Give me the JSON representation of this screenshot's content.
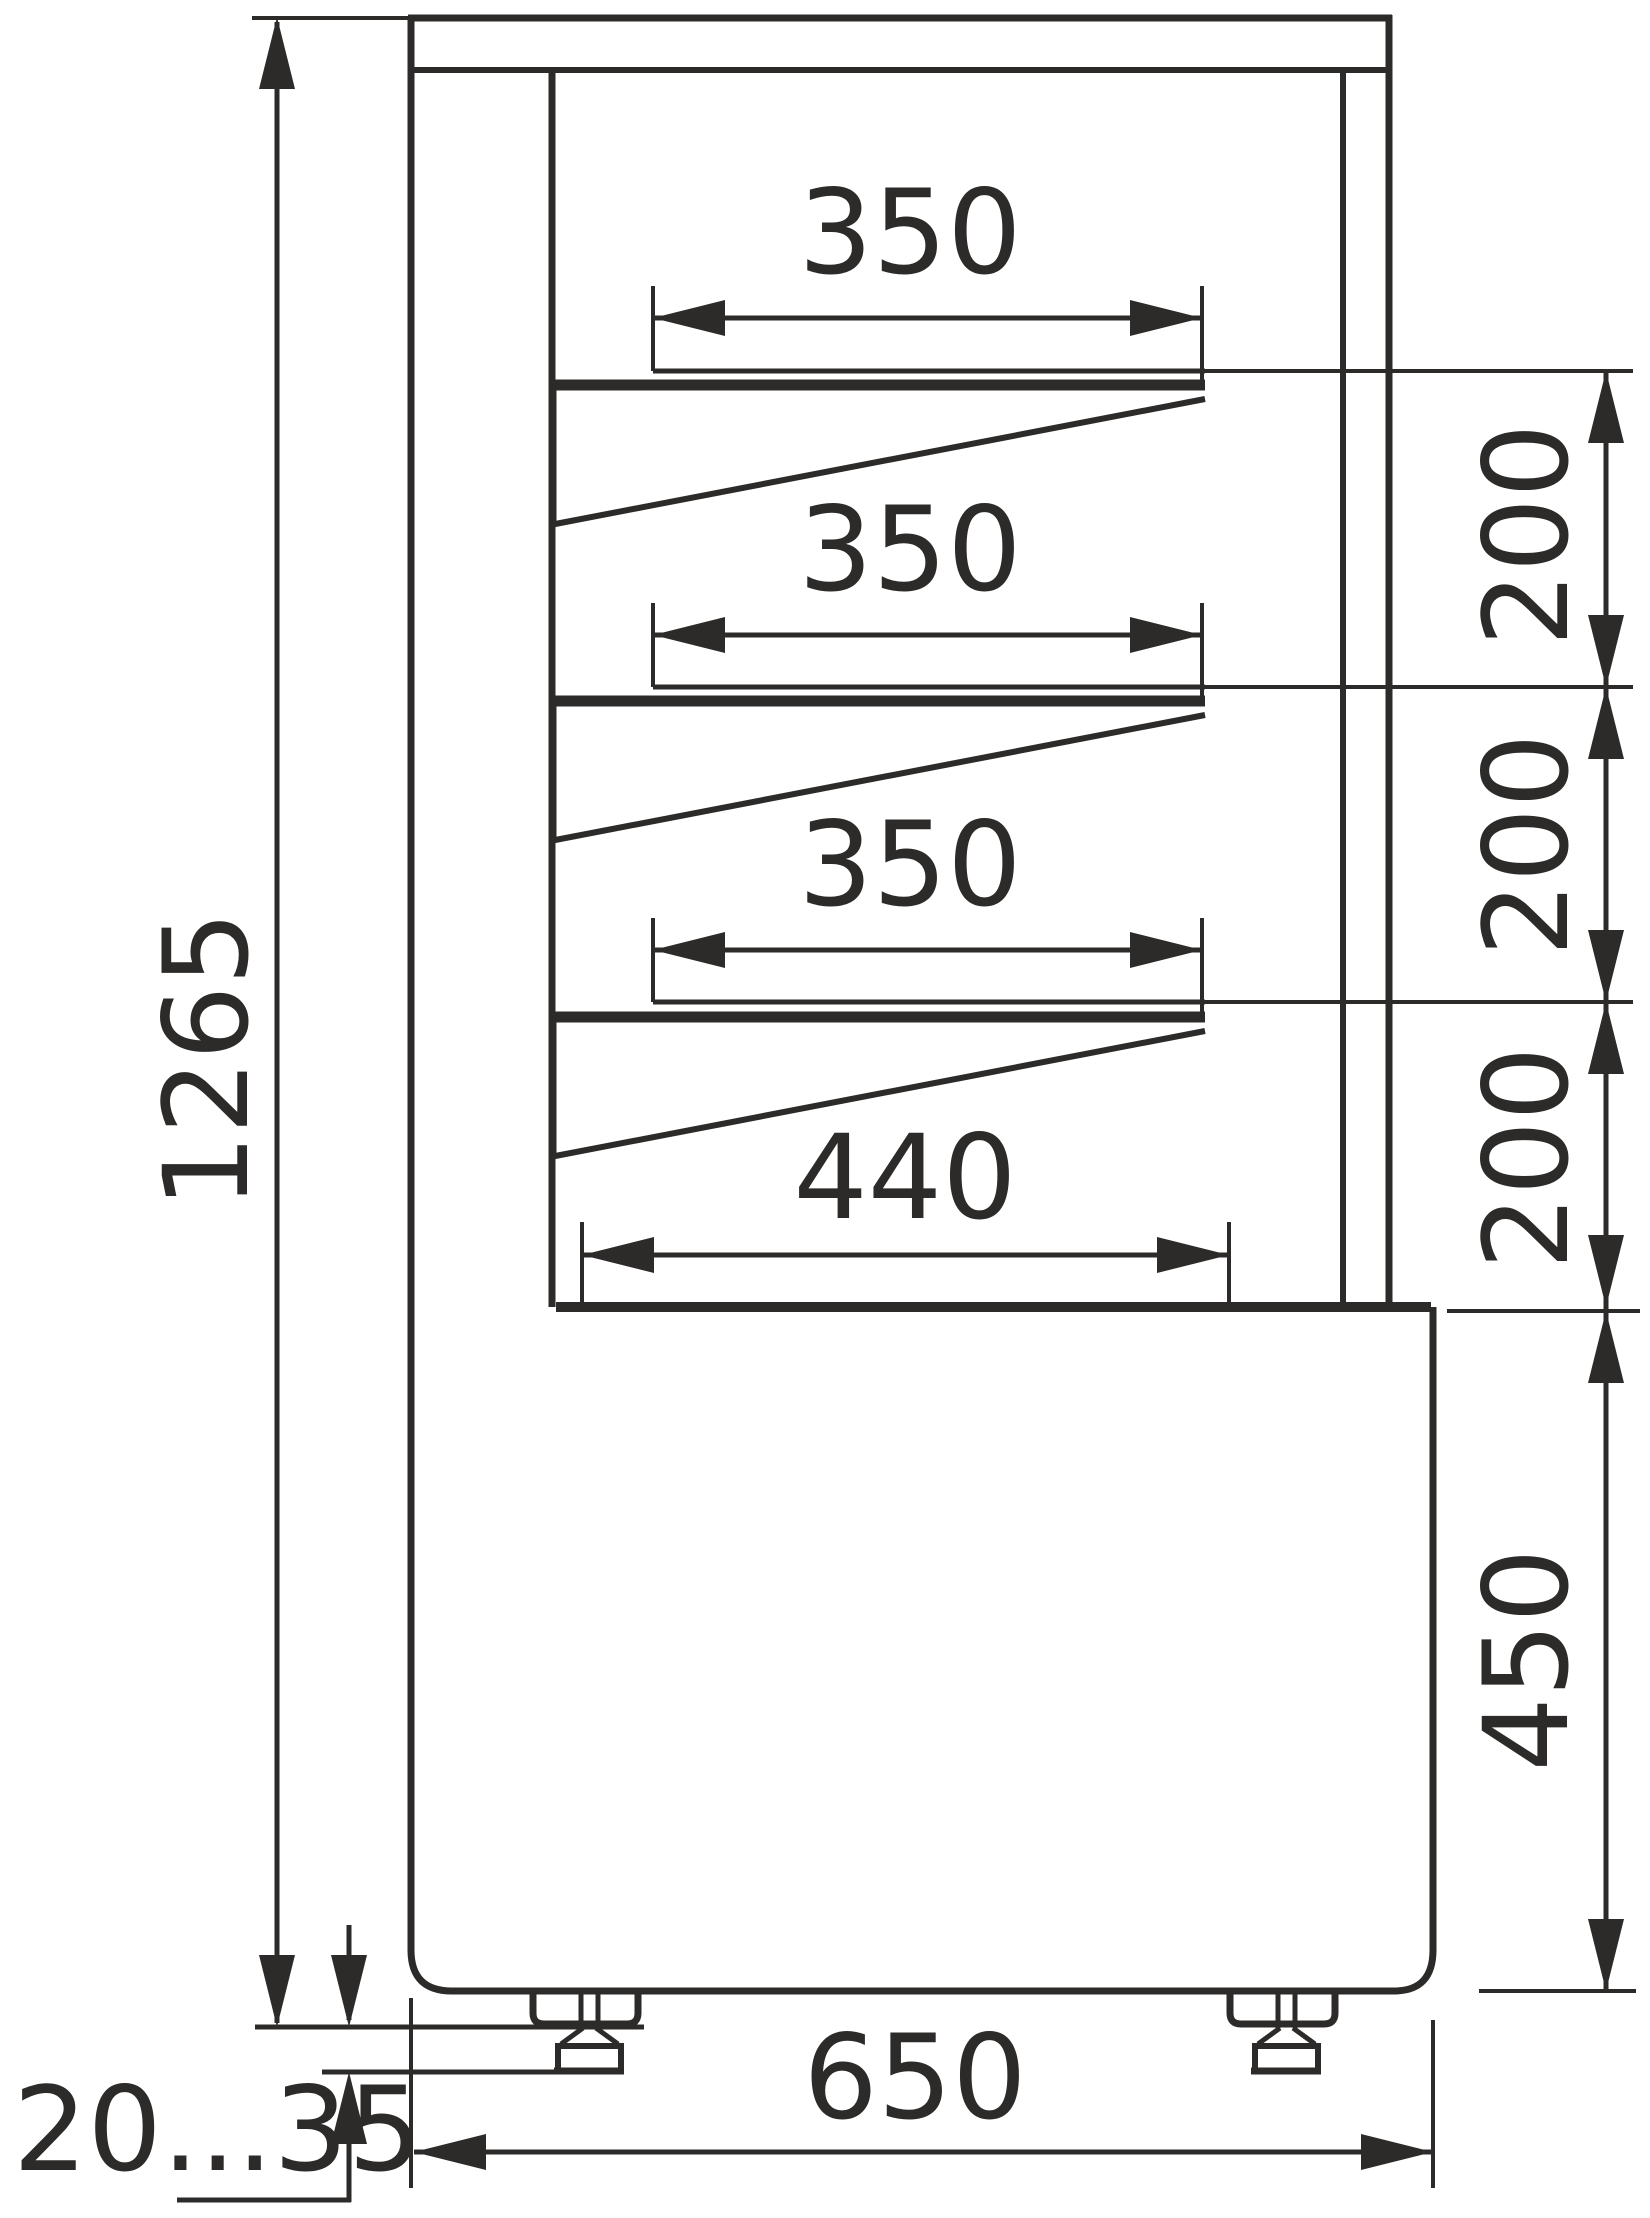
{
  "colors": {
    "ink": "#2d2b29",
    "background": "#ffffff"
  },
  "dimensions": {
    "overall_height": {
      "value": "1265"
    },
    "shelf_widths": [
      {
        "value": "350"
      },
      {
        "value": "350"
      },
      {
        "value": "350"
      }
    ],
    "shelf_spacings": [
      {
        "value": "200"
      },
      {
        "value": "200"
      },
      {
        "value": "200"
      }
    ],
    "bottom_deck_width": {
      "value": "440"
    },
    "base_height": {
      "value": "450"
    },
    "overall_depth": {
      "value": "650"
    },
    "foot_adjustment_range": {
      "value": "20...35"
    }
  }
}
